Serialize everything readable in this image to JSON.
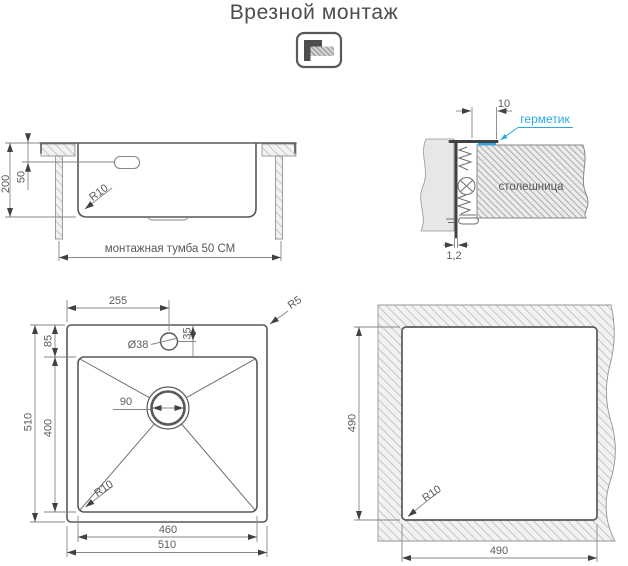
{
  "title": "Врезной монтаж",
  "colors": {
    "line": "#58595B",
    "accent": "#29ABE2"
  },
  "side_view": {
    "depth": "200",
    "flange_depth": "50",
    "bottom_radius": "R10",
    "cabinet": "монтажная тумба 50 СМ"
  },
  "section_detail": {
    "flange_width": "10",
    "sealant": "герметик",
    "countertop": "столешница",
    "thickness": "1,2"
  },
  "top_view": {
    "faucet_offset_x": "255",
    "rim_to_bowl": "85",
    "faucet_offset_y": "35",
    "faucet_diameter": "Ø38",
    "drain_diameter": "90",
    "bowl_height": "400",
    "overall_height": "510",
    "bowl_width": "460",
    "overall_width": "510",
    "bowl_radius": "R10",
    "corner_radius": "R5"
  },
  "cutout_view": {
    "height": "490",
    "width": "490",
    "corner_radius": "R10"
  }
}
